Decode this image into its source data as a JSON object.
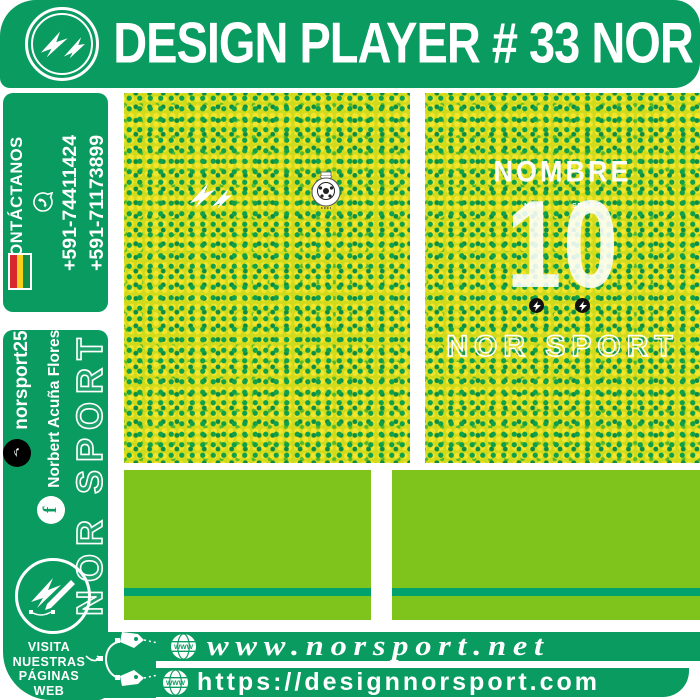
{
  "colors": {
    "green": "#0a9b60",
    "lime": "#7ec41d",
    "stripe": "#00a16b",
    "pattern-base": "#d2da1c",
    "dot-main": "#0fa04c",
    "dot-dark": "#0c8c44",
    "flag-red": "#d8282f",
    "flag-yellow": "#f7d117",
    "flag-green": "#148c45"
  },
  "banner": {
    "title": "DESIGN PLAYER # 33 NOR"
  },
  "contact": {
    "label": "CONTÁCTANOS",
    "phone1": "+591-74411424",
    "phone2": "+591-71173899"
  },
  "social": {
    "tiktok_handle": "norsport25",
    "facebook_name": "Norbert Acuña Flores",
    "logo_text": "NOR SPORT",
    "visit1": "VISITA",
    "visit2": "NUESTRAS",
    "visit3": "PÁGINAS",
    "visit4": "WEB"
  },
  "jersey_back": {
    "name_placeholder": "NOMBRE",
    "number": "10",
    "number_label_left": "NOR",
    "number_label_right": "SPORT",
    "brand": "NOR SPORT"
  },
  "footer": {
    "url1": "www.norsport.net",
    "url2": "https://designnorsport.com"
  },
  "icons": {
    "globe_text": "WWW",
    "tiktok_glyph": "♪",
    "facebook_glyph": "f"
  }
}
